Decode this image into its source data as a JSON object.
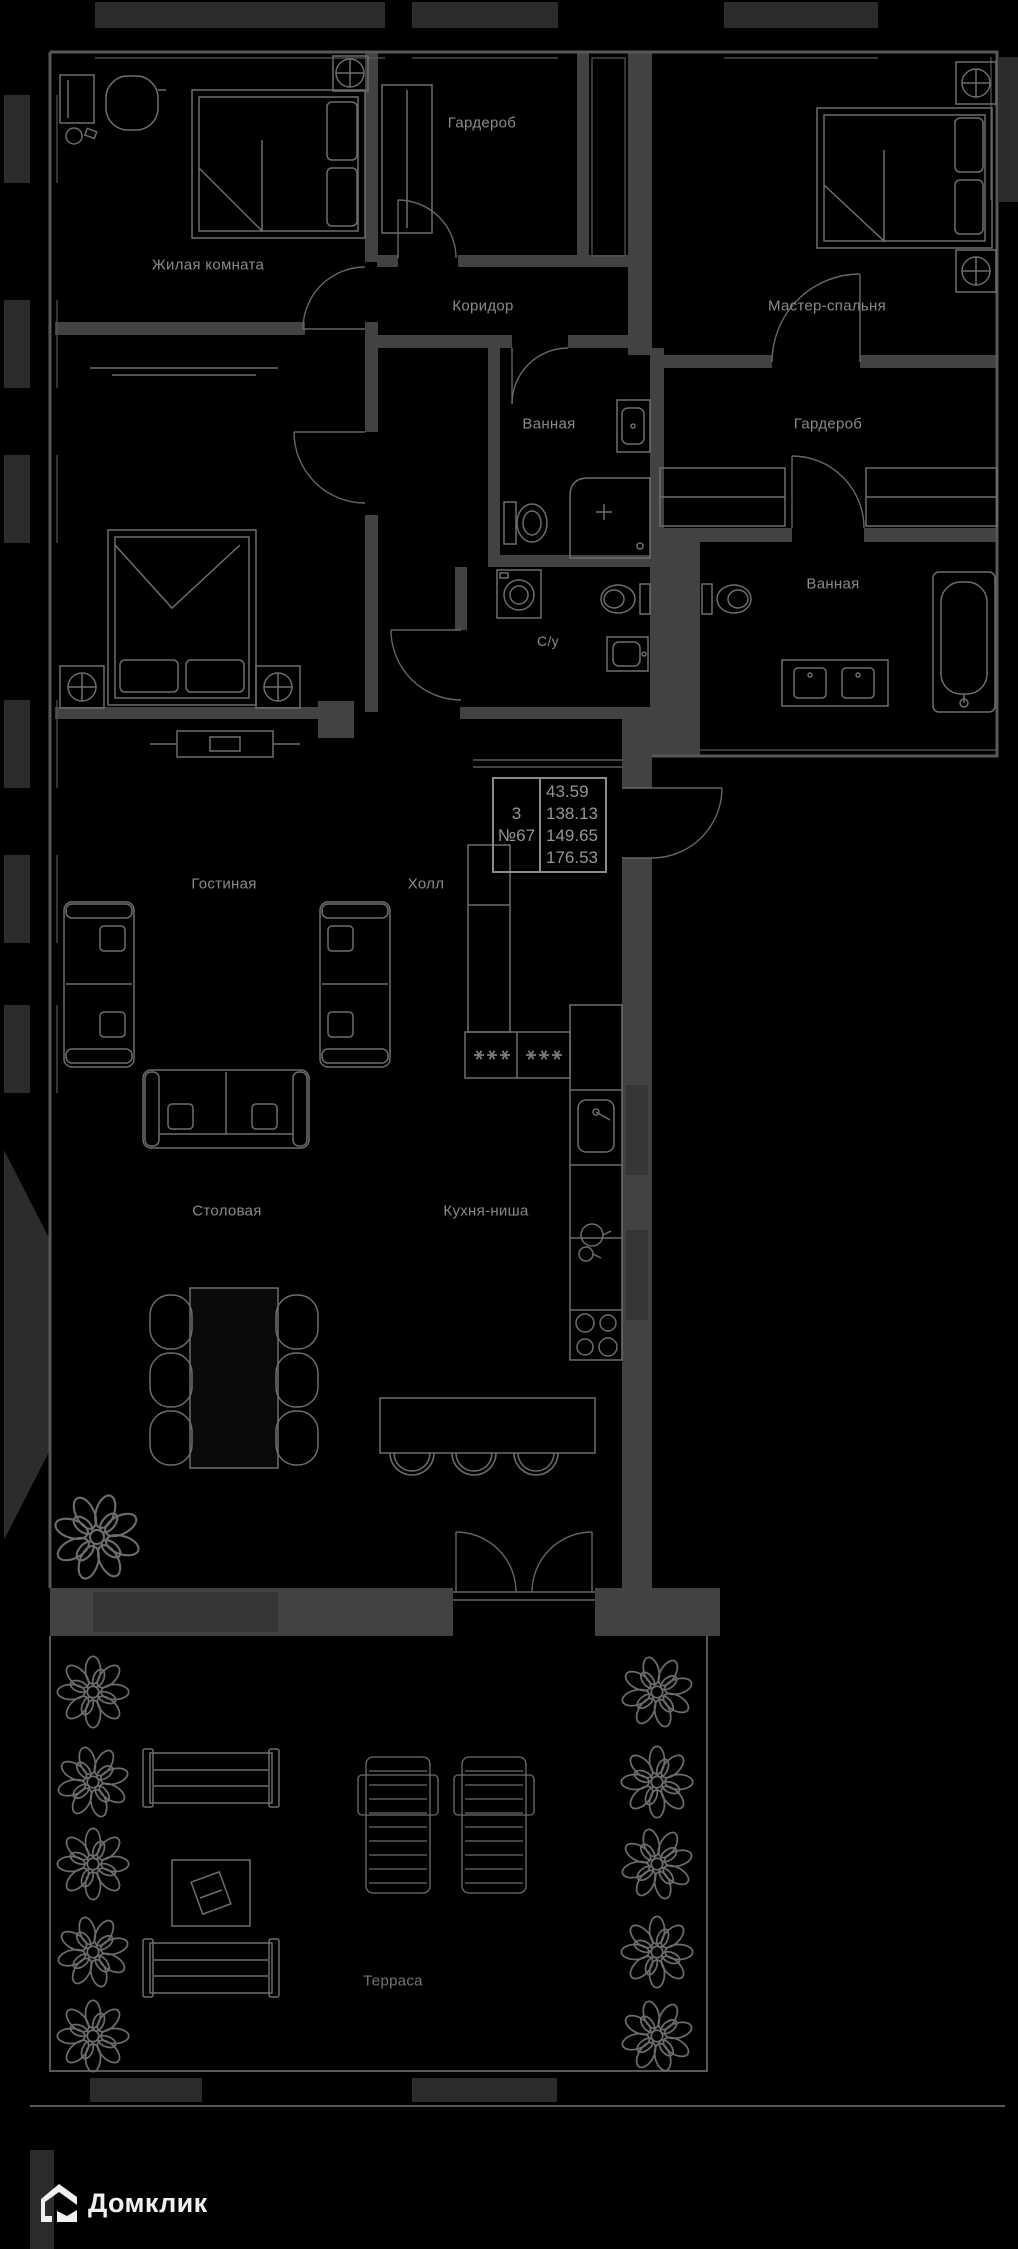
{
  "meta": {
    "width": 1018,
    "height": 2249,
    "background": "#000000",
    "type": "apartment floor plan"
  },
  "colors": {
    "background": "#000000",
    "wall": "#424242",
    "facade": "#2c2c2c",
    "window_band": "#363636",
    "furniture_line": "#6d6d6d",
    "label_text": "#8a8a8a",
    "info_text": "#969696",
    "logo_text": "#f0f0f0"
  },
  "rooms": [
    {
      "id": "living-room-1",
      "label": "Жилая комната"
    },
    {
      "id": "wardrobe-1",
      "label": "Гардероб"
    },
    {
      "id": "corridor",
      "label": "Коридор"
    },
    {
      "id": "master-bedroom",
      "label": "Мастер-спальня"
    },
    {
      "id": "bathroom-1",
      "label": "Ванная"
    },
    {
      "id": "wardrobe-2",
      "label": "Гардероб"
    },
    {
      "id": "toilet",
      "label": "С/у"
    },
    {
      "id": "bathroom-2",
      "label": "Ванная"
    },
    {
      "id": "living-room-2",
      "label": "Гостиная"
    },
    {
      "id": "hall",
      "label": "Холл"
    },
    {
      "id": "dining-room",
      "label": "Столовая"
    },
    {
      "id": "kitchen-niche",
      "label": "Кухня-ниша"
    },
    {
      "id": "terrace",
      "label": "Терраса"
    }
  ],
  "info_box": {
    "rooms_count": "3",
    "unit_number": "№67",
    "areas": [
      "43.59",
      "138.13",
      "149.65",
      "176.53"
    ]
  },
  "logo": {
    "brand": "Домклик"
  }
}
